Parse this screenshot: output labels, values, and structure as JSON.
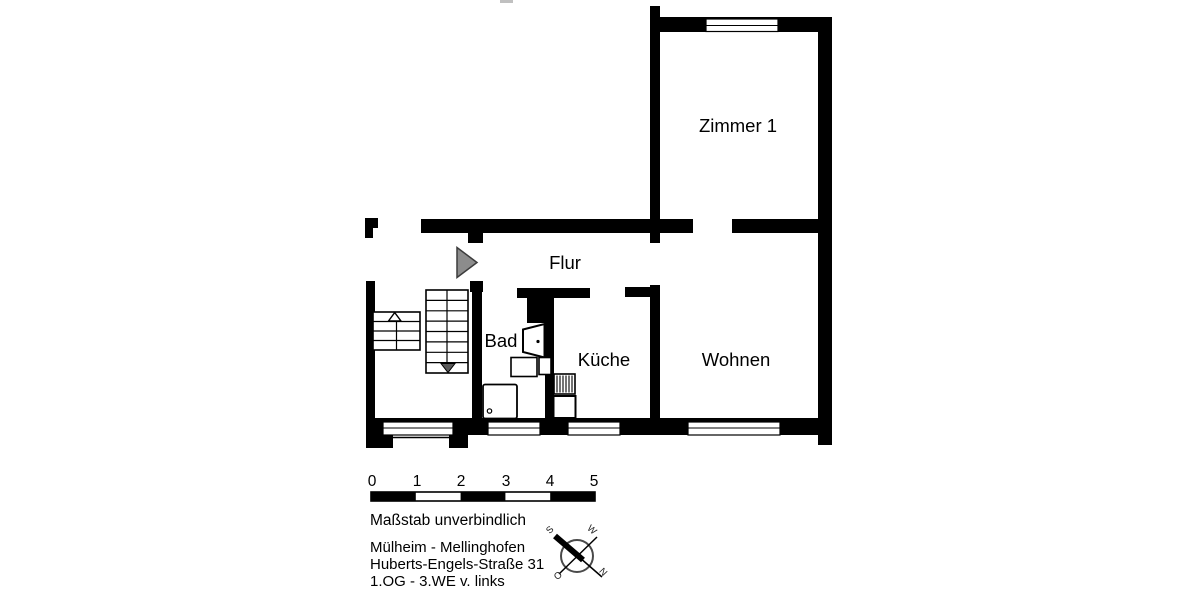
{
  "plan": {
    "rooms": [
      {
        "id": "zimmer1",
        "label": "Zimmer 1"
      },
      {
        "id": "flur",
        "label": "Flur"
      },
      {
        "id": "bad",
        "label": "Bad"
      },
      {
        "id": "kueche",
        "label": "Küche"
      },
      {
        "id": "wohnen",
        "label": "Wohnen"
      }
    ]
  },
  "scale_bar": {
    "ticks": [
      "0",
      "1",
      "2",
      "3",
      "4",
      "5"
    ],
    "caption": "Maßstab unverbindlich"
  },
  "address": {
    "district": "Mülheim - Mellinghofen",
    "street": "Huberts-Engels-Straße 31",
    "unit": "1.OG - 3.WE v. links"
  },
  "compass": {
    "north": "N",
    "south": "S",
    "east": "O",
    "west": "W"
  },
  "colors": {
    "wall": "#000000",
    "entrance_arrow": "#8c8c8c",
    "stair_down_arrow": "#5a5a5a",
    "background": "#ffffff"
  }
}
